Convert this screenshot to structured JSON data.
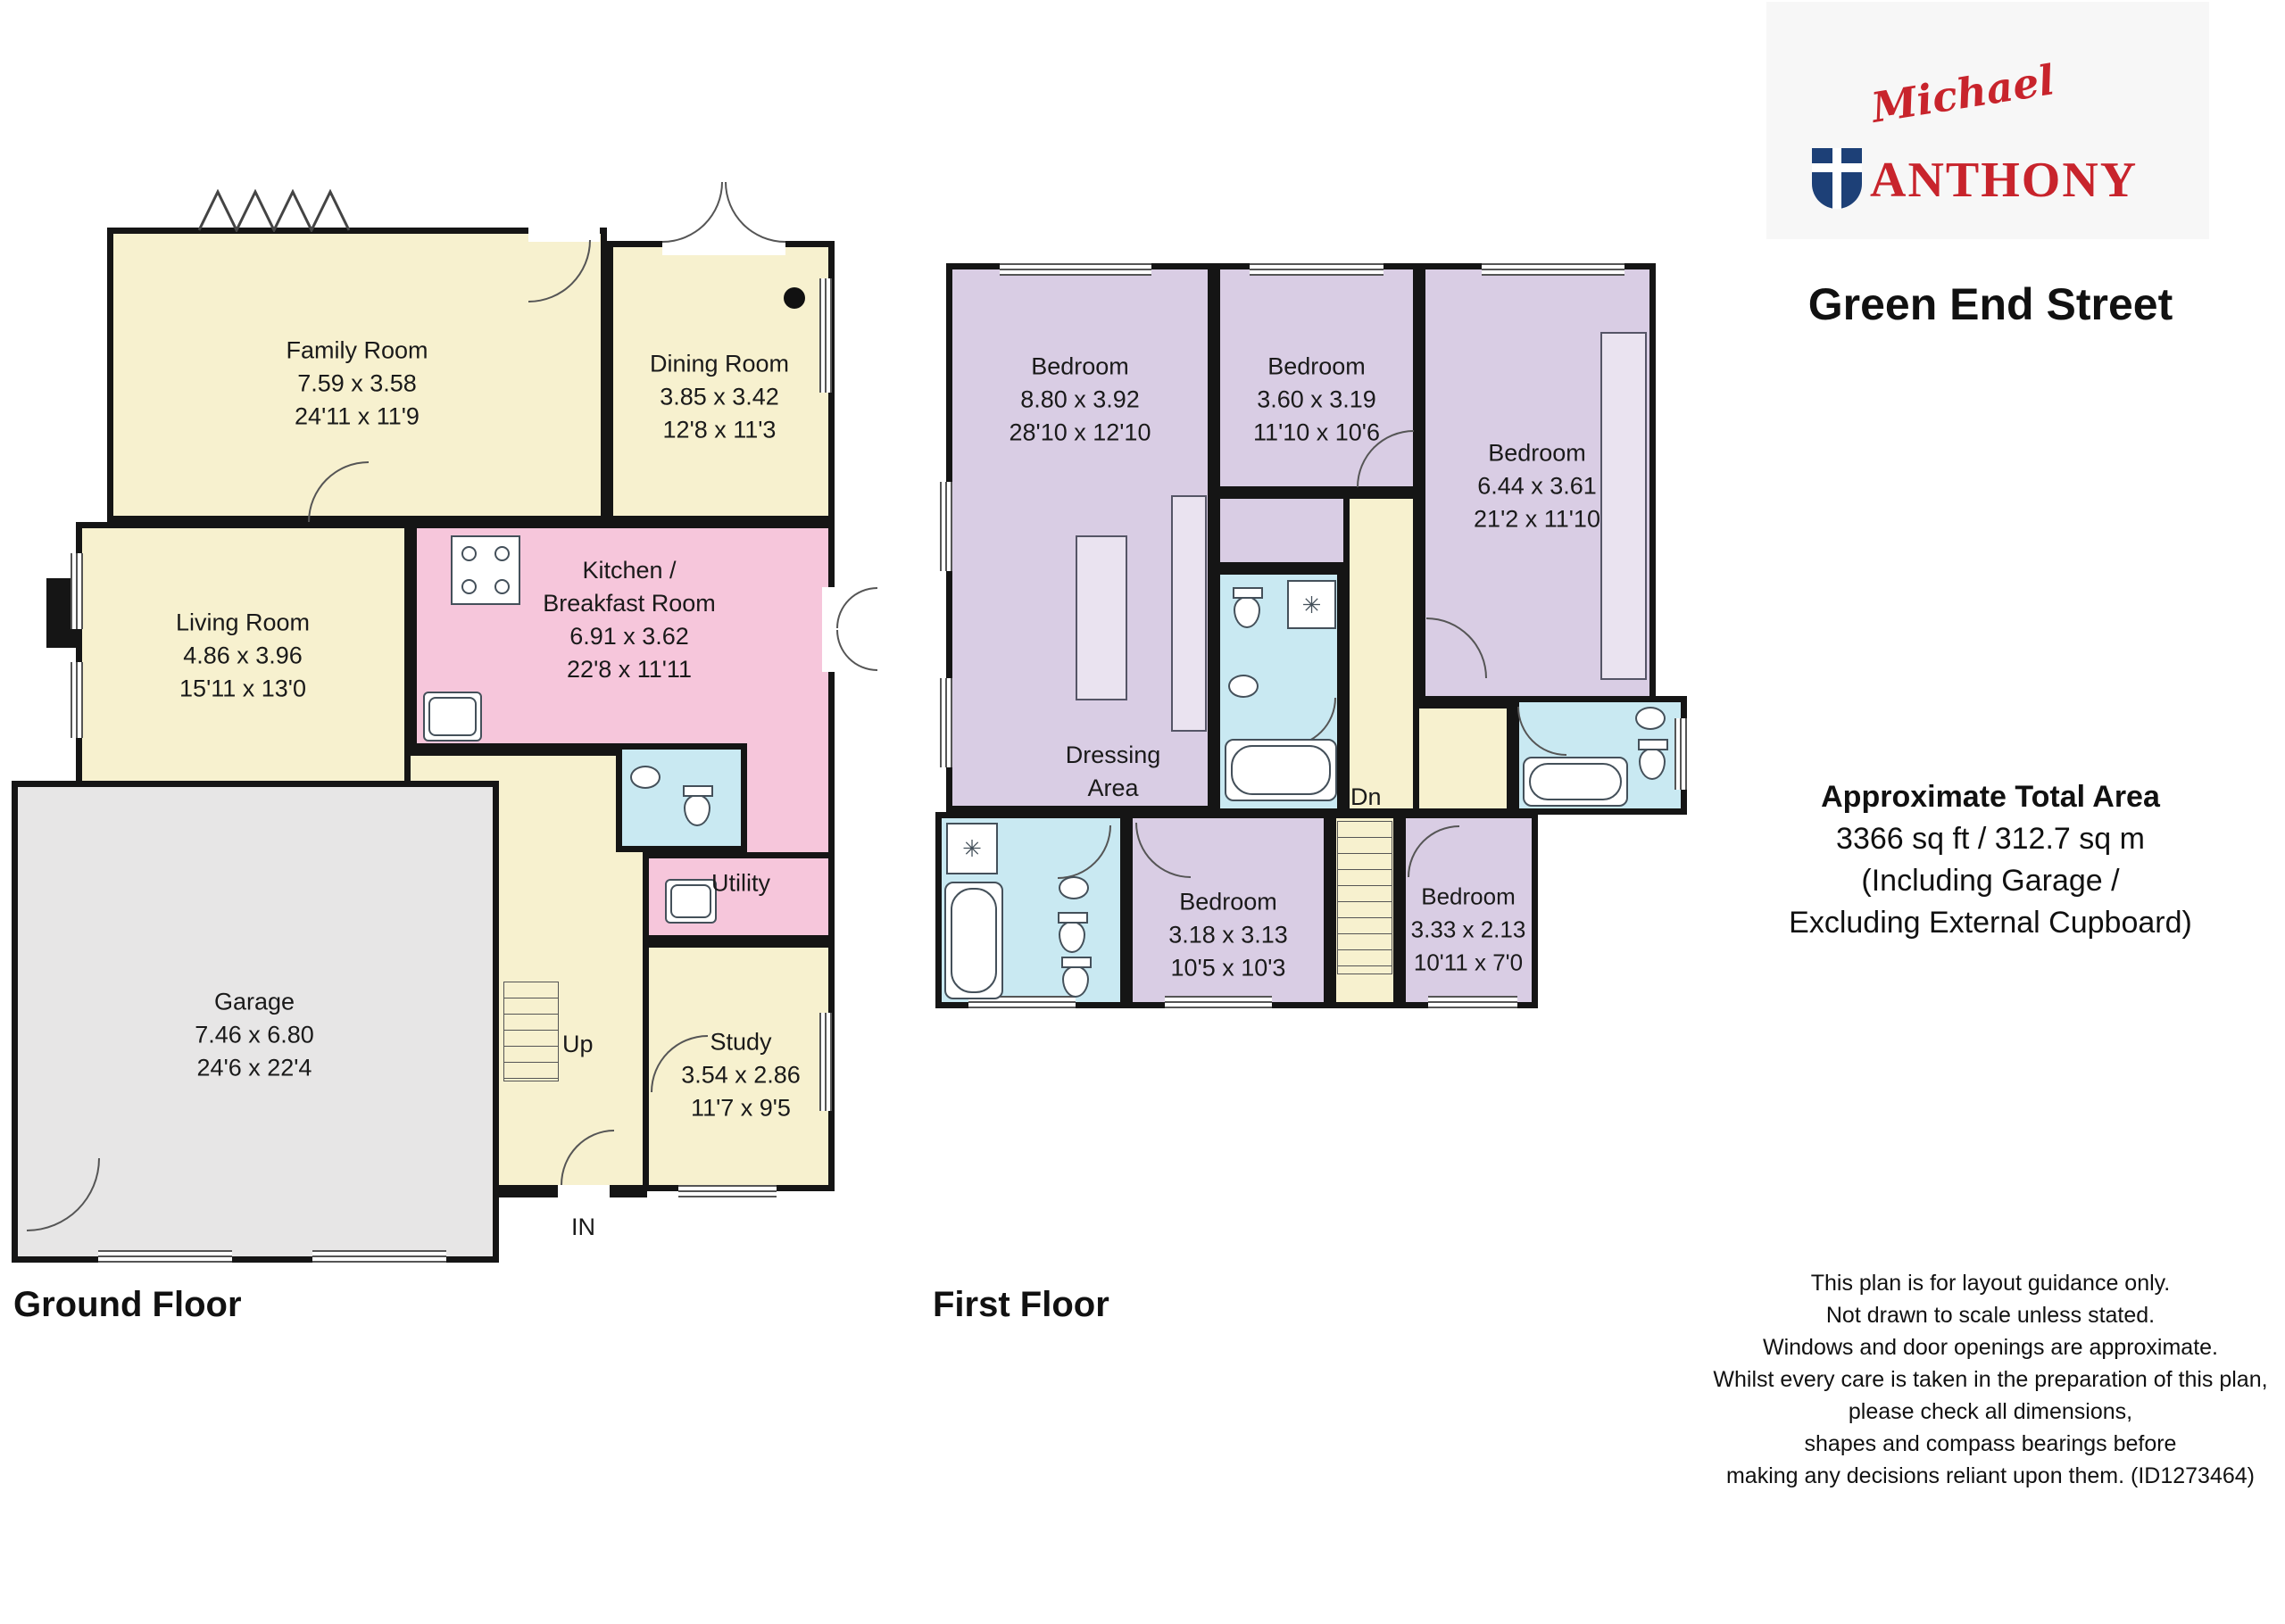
{
  "branding": {
    "script": "Michael",
    "caps": "ANTHONY"
  },
  "title": "Green End Street",
  "area": {
    "heading": "Approximate Total Area",
    "sqft_sqm": "3366 sq ft / 312.7 sq m",
    "including": "(Including Garage /",
    "excluding": "Excluding External Cupboard)"
  },
  "disclaimer": [
    "This plan is for layout guidance only.",
    "Not drawn to scale unless stated.",
    "Windows and door openings are approximate.",
    "Whilst every care is taken in the preparation of this plan,",
    "please check all dimensions,",
    "shapes and compass bearings before",
    "making any decisions reliant upon them. (ID1273464)"
  ],
  "ground": {
    "label": "Ground Floor",
    "stairs": "Up",
    "entrance": "IN",
    "rooms": {
      "family": {
        "name": "Family Room",
        "metric": "7.59 x 3.58",
        "imperial": "24'11 x 11'9"
      },
      "dining": {
        "name": "Dining Room",
        "metric": "3.85 x 3.42",
        "imperial": "12'8 x 11'3"
      },
      "living": {
        "name": "Living Room",
        "metric": "4.86 x 3.96",
        "imperial": "15'11 x 13'0"
      },
      "kitchen": {
        "name1": "Kitchen /",
        "name2": "Breakfast Room",
        "metric": "6.91 x 3.62",
        "imperial": "22'8 x 11'11"
      },
      "utility": {
        "name": "Utility"
      },
      "garage": {
        "name": "Garage",
        "metric": "7.46 x 6.80",
        "imperial": "24'6 x 22'4"
      },
      "study": {
        "name": "Study",
        "metric": "3.54 x 2.86",
        "imperial": "11'7 x 9'5"
      }
    }
  },
  "first": {
    "label": "First Floor",
    "stairs": "Dn",
    "rooms": {
      "bedroom1": {
        "name": "Bedroom",
        "metric": "8.80 x 3.92",
        "imperial": "28'10 x 12'10"
      },
      "bedroom2": {
        "name": "Bedroom",
        "metric": "3.60 x 3.19",
        "imperial": "11'10 x 10'6"
      },
      "bedroom3": {
        "name": "Bedroom",
        "metric": "6.44 x 3.61",
        "imperial": "21'2 x 11'10"
      },
      "bedroom4": {
        "name": "Bedroom",
        "metric": "3.18 x 3.13",
        "imperial": "10'5 x 10'3"
      },
      "bedroom5": {
        "name": "Bedroom",
        "metric": "3.33 x 2.13",
        "imperial": "10'11 x 7'0"
      },
      "dressing": {
        "name1": "Dressing",
        "name2": "Area"
      }
    }
  },
  "colors": {
    "room_yellow": "#f7f1cf",
    "room_pink": "#f6c6db",
    "room_lavender": "#d9cde4",
    "room_blue": "#c9e9f2",
    "garage_gray": "#e7e6e6",
    "wall": "#151515",
    "logo_red": "#c8242c",
    "shield_blue": "#1d4077"
  }
}
